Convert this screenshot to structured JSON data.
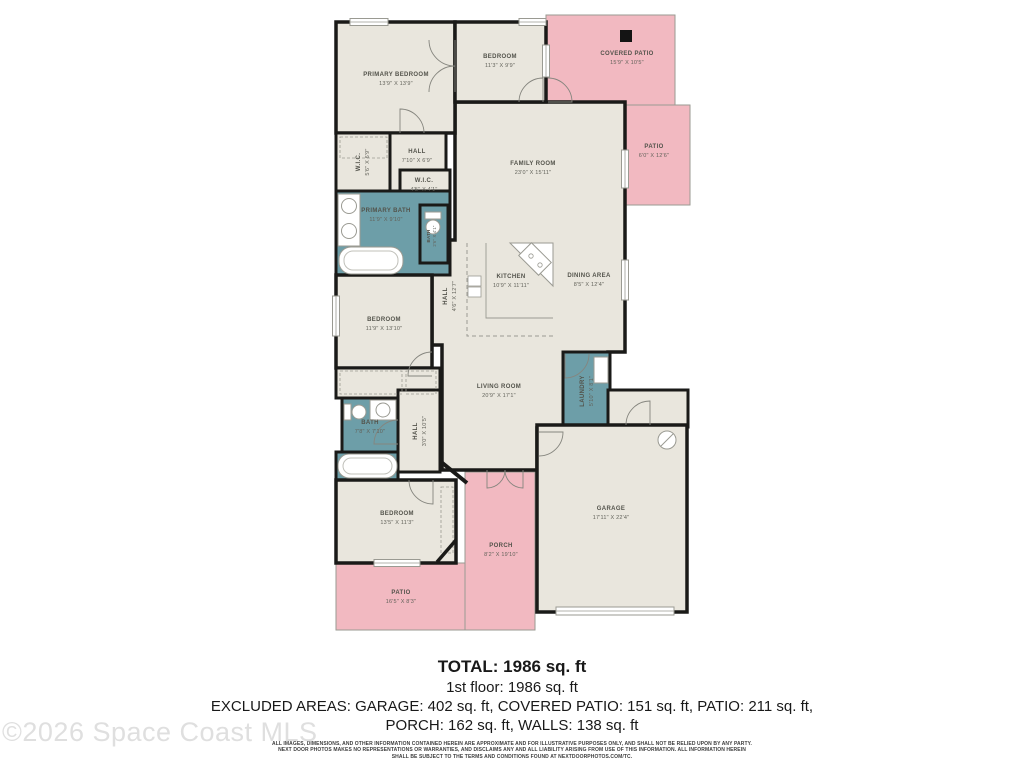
{
  "plan": {
    "colors": {
      "floor": "#e9e6dd",
      "wet": "#6d9ea8",
      "outdoor": "#f2b9c1",
      "wall": "#1a1a18",
      "outline": "#9a9a92",
      "fixture": "#9a9a92",
      "marker": "#141414"
    },
    "rooms_outdoor": [
      {
        "id": "covered-patio",
        "name": "COVERED PATIO",
        "dims": "15'9\" X 10'5\"",
        "x": 546,
        "y": 15,
        "w": 129,
        "h": 90,
        "fill": "outdoor",
        "wall": 1,
        "lx": 627,
        "ly": 55
      },
      {
        "id": "patio",
        "name": "PATIO",
        "dims": "6'0\" X 12'6\"",
        "x": 623,
        "y": 105,
        "w": 67,
        "h": 100,
        "fill": "outdoor",
        "wall": 1,
        "lx": 654,
        "ly": 148
      },
      {
        "id": "patio-2",
        "name": "PATIO",
        "dims": "16'5\" X 8'3\"",
        "x": 336,
        "y": 563,
        "w": 129,
        "h": 67,
        "fill": "outdoor",
        "wall": 1,
        "lx": 401,
        "ly": 594
      },
      {
        "id": "porch",
        "name": "PORCH",
        "dims": "8'2\" X 19'10\"",
        "x": 465,
        "y": 472,
        "w": 70,
        "h": 158,
        "fill": "outdoor",
        "wall": 1,
        "lx": 501,
        "ly": 547
      }
    ],
    "open_area": {
      "path": "M455,102 H625 V352 H608 V428 H537 V470 H442 V345 H432 V240 H455 Z",
      "labels": [
        {
          "name": "FAMILY ROOM",
          "dims": "23'0\" X 15'11\"",
          "lx": 533,
          "ly": 165
        },
        {
          "name": "KITCHEN",
          "dims": "10'9\" X 11'11\"",
          "lx": 511,
          "ly": 278
        },
        {
          "name": "DINING AREA",
          "dims": "8'5\" X 12'4\"",
          "lx": 589,
          "ly": 277
        },
        {
          "name": "LIVING ROOM",
          "dims": "20'9\" X 17'1\"",
          "lx": 499,
          "ly": 388
        },
        {
          "name": "HALL",
          "dims": "4'6\" X 12'7\"",
          "lx": 447,
          "ly": 296,
          "rot": -90
        }
      ]
    },
    "rooms": [
      {
        "id": "primary-bedroom",
        "name": "PRIMARY BEDROOM",
        "dims": "13'9\" X 13'9\"",
        "x": 336,
        "y": 22,
        "w": 119,
        "h": 111,
        "fill": "floor",
        "wall": 3.5,
        "lx": 396,
        "ly": 76
      },
      {
        "id": "bedroom-2",
        "name": "BEDROOM",
        "dims": "11'3\" X 9'9\"",
        "x": 455,
        "y": 22,
        "w": 91,
        "h": 80,
        "fill": "floor",
        "wall": 3.5,
        "lx": 500,
        "ly": 58
      },
      {
        "id": "wic",
        "name": "W.I.C.",
        "dims": "5'6\" X 6'9\"",
        "x": 336,
        "y": 133,
        "w": 54,
        "h": 58,
        "fill": "floor",
        "wall": 3,
        "rot": -90,
        "lx": 360,
        "ly": 162
      },
      {
        "id": "hall",
        "name": "HALL",
        "dims": "7'10\" X 6'9\"",
        "x": 390,
        "y": 133,
        "w": 56,
        "h": 62,
        "fill": "floor",
        "wall": 3,
        "lx": 417,
        "ly": 153
      },
      {
        "id": "wic-2",
        "name": "W.I.C.",
        "dims": "4'5\" X 4'1\"",
        "x": 400,
        "y": 170,
        "w": 50,
        "h": 35,
        "fill": "floor",
        "wall": 3,
        "lx": 424,
        "ly": 182
      },
      {
        "id": "primary-bath",
        "name": "PRIMARY BATH",
        "dims": "11'9\" X 9'10\"",
        "x": 336,
        "y": 191,
        "w": 114,
        "h": 84,
        "fill": "wet",
        "wall": 3,
        "lx": 386,
        "ly": 212
      },
      {
        "id": "water-closet",
        "name": "BATH",
        "dims": "2'6\" X 4'1\"",
        "x": 420,
        "y": 205,
        "w": 28,
        "h": 58,
        "fill": "wet",
        "wall": 3,
        "rot": -90,
        "lx": 430,
        "ly": 236,
        "small": true
      },
      {
        "id": "bedroom-3",
        "name": "BEDROOM",
        "dims": "11'9\" X 13'10\"",
        "x": 336,
        "y": 275,
        "w": 96,
        "h": 93,
        "fill": "floor",
        "wall": 3.5,
        "lx": 384,
        "ly": 321
      },
      {
        "id": "closet",
        "name": "",
        "dims": "",
        "x": 336,
        "y": 368,
        "w": 104,
        "h": 30,
        "fill": "floor",
        "wall": 3
      },
      {
        "id": "bath-2",
        "name": "BATH",
        "dims": "7'8\" X 7'10\"",
        "x": 342,
        "y": 398,
        "w": 56,
        "h": 58,
        "fill": "wet",
        "wall": 3,
        "lx": 370,
        "ly": 424
      },
      {
        "id": "bath-2-tub",
        "name": "",
        "dims": "",
        "x": 336,
        "y": 452,
        "w": 62,
        "h": 28,
        "fill": "wet",
        "wall": 3
      },
      {
        "id": "hall-2",
        "name": "HALL",
        "dims": "3'0\" X 10'5\"",
        "x": 398,
        "y": 390,
        "w": 42,
        "h": 82,
        "fill": "floor",
        "wall": 3,
        "rot": -90,
        "lx": 417,
        "ly": 431
      },
      {
        "id": "bedroom-4",
        "name": "BEDROOM",
        "dims": "13'5\" X 11'3\"",
        "x": 336,
        "y": 480,
        "w": 120,
        "h": 83,
        "fill": "floor",
        "wall": 3.5,
        "lx": 397,
        "ly": 515
      },
      {
        "id": "laundry",
        "name": "LAUNDRY",
        "dims": "5'10\" X 8'1\"",
        "x": 563,
        "y": 352,
        "w": 47,
        "h": 78,
        "fill": "wet",
        "wall": 3,
        "rot": -90,
        "lx": 584,
        "ly": 391
      },
      {
        "id": "entry-vestibule",
        "name": "",
        "dims": "",
        "x": 608,
        "y": 390,
        "w": 80,
        "h": 37,
        "fill": "floor",
        "wall": 3
      },
      {
        "id": "garage",
        "name": "GARAGE",
        "dims": "17'11\" X 22'4\"",
        "x": 537,
        "y": 425,
        "w": 150,
        "h": 187,
        "fill": "floor",
        "wall": 3.5,
        "lx": 611,
        "ly": 510
      }
    ],
    "windows": [
      {
        "x": 350,
        "y": 18.5,
        "w": 38,
        "h": 7
      },
      {
        "x": 519,
        "y": 18.5,
        "w": 27,
        "h": 7
      },
      {
        "x": 542.5,
        "y": 45,
        "w": 7,
        "h": 32
      },
      {
        "x": 621.5,
        "y": 150,
        "w": 7,
        "h": 38
      },
      {
        "x": 621.5,
        "y": 260,
        "w": 7,
        "h": 40
      },
      {
        "x": 332.5,
        "y": 296,
        "w": 7,
        "h": 40
      },
      {
        "x": 374,
        "y": 559.5,
        "w": 46,
        "h": 7
      },
      {
        "x": 556,
        "y": 607,
        "w": 118,
        "h": 8
      }
    ],
    "fixtures": [
      {
        "t": "rect",
        "x": 620,
        "y": 30,
        "w": 12,
        "h": 12,
        "f": "#141414",
        "n": "patio-marker"
      },
      {
        "t": "rect",
        "x": 340,
        "y": 137,
        "w": 47,
        "h": 21,
        "f": "none",
        "s": "#9a9a92",
        "sw": 0.8,
        "dash": "3,2",
        "n": "closet-rod"
      },
      {
        "t": "rect",
        "x": 340,
        "y": 371,
        "w": 62,
        "h": 23,
        "f": "none",
        "s": "#9a9a92",
        "sw": 0.8,
        "dash": "3,2",
        "n": "closet-rod"
      },
      {
        "t": "rect",
        "x": 406,
        "y": 371,
        "w": 30,
        "h": 23,
        "f": "none",
        "s": "#9a9a92",
        "sw": 0.8,
        "dash": "3,2",
        "n": "closet-rod"
      },
      {
        "t": "rect",
        "x": 441,
        "y": 487,
        "w": 12,
        "h": 66,
        "f": "none",
        "s": "#9a9a92",
        "sw": 0.8,
        "dash": "3,2",
        "n": "closet-rod"
      },
      {
        "t": "path",
        "d": "M467,243 V336 H553",
        "f": "none",
        "s": "#9a9a92",
        "sw": 1,
        "dash": "4,3",
        "n": "kitchen-upper-cabinets"
      },
      {
        "t": "path",
        "d": "M486,243 V318 H553",
        "f": "none",
        "s": "#9a9a92",
        "sw": 0.9,
        "n": "kitchen-counter"
      },
      {
        "t": "path",
        "d": "M510,243 L553,243 L553,286 Z",
        "f": "#ffffff",
        "s": "#9a9a92",
        "sw": 1,
        "n": "kitchen-corner-counter"
      },
      {
        "t": "rect",
        "x": 521,
        "y": 250,
        "w": 28,
        "h": 18,
        "rot": 45,
        "f": "#ffffff",
        "s": "#9a9a92",
        "sw": 1,
        "n": "stove"
      },
      {
        "t": "circle",
        "cx": 531,
        "cy": 256,
        "r": 2.2,
        "f": "none",
        "s": "#9a9a92",
        "sw": 0.8,
        "n": "burner"
      },
      {
        "t": "circle",
        "cx": 540,
        "cy": 265,
        "r": 2.2,
        "f": "none",
        "s": "#9a9a92",
        "sw": 0.8,
        "n": "burner"
      },
      {
        "t": "rect",
        "x": 468,
        "y": 276,
        "w": 13,
        "h": 10,
        "f": "#ffffff",
        "s": "#9a9a92",
        "sw": 0.8,
        "n": "kitchen-sink"
      },
      {
        "t": "rect",
        "x": 468,
        "y": 287,
        "w": 13,
        "h": 10,
        "f": "#ffffff",
        "s": "#9a9a92",
        "sw": 0.8,
        "n": "kitchen-sink"
      },
      {
        "t": "rect",
        "x": 338,
        "y": 194,
        "w": 22,
        "h": 52,
        "f": "#ffffff",
        "s": "#9a9a92",
        "sw": 1,
        "n": "vanity"
      },
      {
        "t": "circle",
        "cx": 349,
        "cy": 206,
        "r": 7.5,
        "f": "#ffffff",
        "s": "#9a9a92",
        "sw": 1,
        "n": "sink"
      },
      {
        "t": "circle",
        "cx": 349,
        "cy": 231,
        "r": 7.5,
        "f": "#ffffff",
        "s": "#9a9a92",
        "sw": 1,
        "n": "sink"
      },
      {
        "t": "rect",
        "x": 339,
        "y": 247,
        "w": 64,
        "h": 27,
        "rx": 12,
        "f": "#ffffff",
        "s": "#9a9a92",
        "sw": 1,
        "n": "bathtub"
      },
      {
        "t": "rect",
        "x": 344,
        "y": 251,
        "w": 54,
        "h": 19,
        "rx": 9,
        "f": "none",
        "s": "#c0c0ba",
        "sw": 1,
        "n": "bathtub-inner"
      },
      {
        "t": "rect",
        "x": 425,
        "y": 212,
        "w": 16,
        "h": 7,
        "f": "#ffffff",
        "s": "#9a9a92",
        "sw": 1,
        "n": "toilet-tank"
      },
      {
        "t": "circle",
        "cx": 433,
        "cy": 227,
        "r": 7,
        "f": "#ffffff",
        "s": "#9a9a92",
        "sw": 1,
        "n": "toilet"
      },
      {
        "t": "rect",
        "x": 344,
        "y": 404,
        "w": 7,
        "h": 16,
        "f": "#ffffff",
        "s": "#9a9a92",
        "sw": 1,
        "n": "toilet-tank"
      },
      {
        "t": "circle",
        "cx": 359,
        "cy": 412,
        "r": 7,
        "f": "#ffffff",
        "s": "#9a9a92",
        "sw": 1,
        "n": "toilet"
      },
      {
        "t": "rect",
        "x": 370,
        "y": 400,
        "w": 26,
        "h": 20,
        "f": "#ffffff",
        "s": "#9a9a92",
        "sw": 1,
        "n": "vanity"
      },
      {
        "t": "circle",
        "cx": 383,
        "cy": 410,
        "r": 7,
        "f": "none",
        "s": "#9a9a92",
        "sw": 1,
        "n": "sink"
      },
      {
        "t": "rect",
        "x": 338,
        "y": 454,
        "w": 59,
        "h": 24,
        "rx": 11,
        "f": "#ffffff",
        "s": "#9a9a92",
        "sw": 1,
        "n": "bathtub"
      },
      {
        "t": "rect",
        "x": 343,
        "y": 458,
        "w": 49,
        "h": 16,
        "rx": 8,
        "f": "none",
        "s": "#c0c0ba",
        "sw": 1,
        "n": "bathtub-inner"
      },
      {
        "t": "rect",
        "x": 594,
        "y": 357,
        "w": 14,
        "h": 26,
        "f": "#ffffff",
        "s": "#9a9a92",
        "sw": 1,
        "n": "washer-dryer"
      },
      {
        "t": "circle",
        "cx": 667,
        "cy": 440,
        "r": 9,
        "f": "#ffffff",
        "s": "#9a9a92",
        "sw": 1,
        "n": "water-heater"
      },
      {
        "t": "line",
        "x1": 661,
        "y1": 446,
        "x2": 673,
        "y2": 434,
        "s": "#9a9a92",
        "sw": 1,
        "n": "water-heater-slash"
      },
      {
        "t": "line",
        "x1": 440,
        "y1": 461,
        "x2": 467,
        "y2": 483,
        "s": "#1a1a18",
        "sw": 4,
        "n": "angled-wall"
      },
      {
        "t": "line",
        "x1": 456,
        "y1": 540,
        "x2": 437,
        "y2": 562,
        "s": "#1a1a18",
        "sw": 3.5,
        "n": "angled-wall"
      }
    ],
    "doors": [
      {
        "d": "M519,102 A24,24 0 0 1 543,78 L543,102",
        "n": "door-bedroom-2"
      },
      {
        "d": "M548,78 A24,24 0 0 1 572,102 L548,102",
        "n": "door-covered-patio"
      },
      {
        "d": "M429,40 A26,26 0 0 0 455,66 L455,40",
        "n": "door-primary-closet"
      },
      {
        "d": "M429,92 A26,26 0 0 1 455,66 L455,92",
        "n": "door-primary-closet"
      },
      {
        "d": "M424,133 A24,24 0 0 0 400,109 L400,133",
        "n": "door-primary-bedroom"
      },
      {
        "d": "M432,352 A24,24 0 0 0 408,376 L432,376",
        "n": "door-bedroom-3"
      },
      {
        "d": "M398,420 A24,24 0 0 0 374,444 L398,444",
        "n": "door-bath"
      },
      {
        "d": "M409,480 A24,24 0 0 0 433,504 L433,480",
        "n": "door-bedroom-4"
      },
      {
        "d": "M589,354 A24,24 0 0 1 565,378 L565,354",
        "n": "door-laundry"
      },
      {
        "d": "M539,456 A24,24 0 0 0 563,432 L539,432",
        "n": "door-garage"
      },
      {
        "d": "M626,425 A24,24 0 0 1 650,401 L650,425",
        "n": "door-entry"
      },
      {
        "d": "M505,470 A18,18 0 0 1 487,488 L487,470",
        "n": "front-door"
      },
      {
        "d": "M505,470 A18,18 0 0 0 523,488 L523,470",
        "n": "front-door"
      }
    ]
  },
  "summary": {
    "total": "TOTAL: 1986 sq. ft",
    "first_floor": "1st floor: 1986 sq. ft",
    "excluded_line1": "EXCLUDED AREAS: GARAGE: 402 sq. ft, COVERED PATIO: 151 sq. ft, PATIO: 211 sq. ft,",
    "excluded_line2": "PORCH: 162 sq. ft, WALLS: 138 sq. ft",
    "disclaimer_line1": "ALL IMAGES, DIMENSIONS, AND OTHER INFORMATION CONTAINED HEREIN ARE APPROXIMATE AND FOR ILLUSTRATIVE PURPOSES ONLY, AND SHALL NOT BE RELIED UPON BY ANY PARTY.",
    "disclaimer_line2": "NEXT DOOR PHOTOS MAKES NO REPRESENTATIONS OR WARRANTIES, AND DISCLAIMS ANY AND ALL LIABILITY ARISING FROM USE OF THIS INFORMATION. ALL INFORMATION HEREIN",
    "disclaimer_line3": "SHALL BE SUBJECT TO THE TERMS AND CONDITIONS FOUND AT NEXTDOORPHOTOS.COM/TC."
  },
  "watermark": "©2026 Space Coast MLS"
}
